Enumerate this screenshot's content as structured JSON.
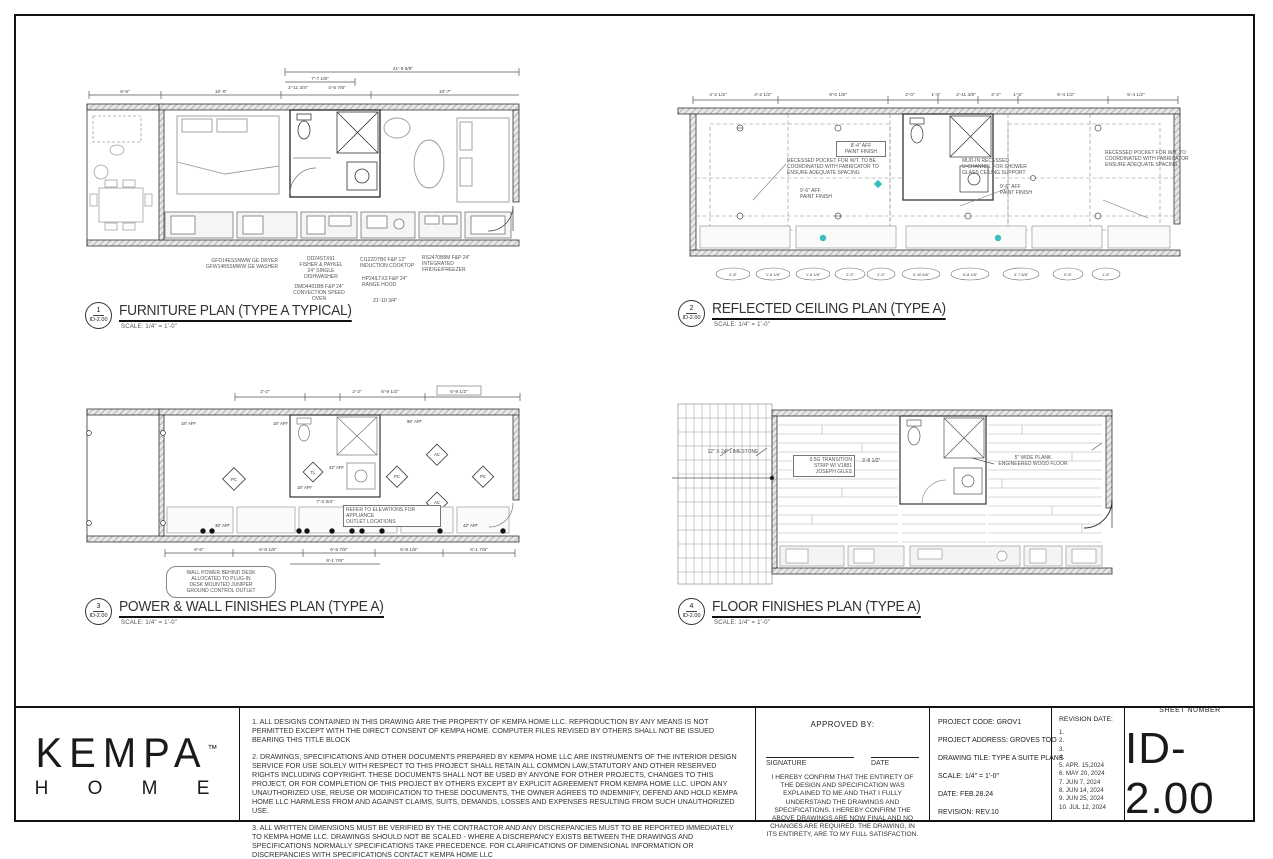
{
  "titles": {
    "furniture": {
      "num": "1",
      "ref": "ID-2.00",
      "title": "FURNITURE PLAN (TYPE A TYPICAL)",
      "scale": "SCALE: 1/4\" = 1'-0\""
    },
    "rcp": {
      "num": "2",
      "ref": "ID-2.00",
      "title": "REFLECTED CEILING PLAN (TYPE A)",
      "scale": "SCALE: 1/4\" = 1'-0\""
    },
    "power": {
      "num": "3",
      "ref": "ID-2.00",
      "title": "POWER & WALL FINISHES PLAN (TYPE A)",
      "scale": "SCALE: 1/4\" = 1'-0\""
    },
    "floor": {
      "num": "4",
      "ref": "ID-2.00",
      "title": "FLOOR FINISHES PLAN (TYPE A)",
      "scale": "SCALE: 1/4\" = 1'-0\""
    }
  },
  "furniture": {
    "dims_top": [
      "21'-9 5/8\"",
      "7'-7 1/8\"",
      "8'-6\"",
      "10'-0\"",
      "10'-7\"",
      "2'-11 3/4\"",
      "4'-5 7/8\""
    ],
    "dim_bottom": "21'-10 3/4\"",
    "notes": [
      "GFD14ESSNWW GE DRYER\nGFW148SSMWW GE WASHER",
      "DD24STX61\nFISHER & PAYKEL\n24\" SINGLE\nDISHWASHER",
      "DMD4401BB F&P 24\"\nCONVECTION SPEED\nOVEN",
      "CI122DTB6 F&P 12\"\nINDUCTION COOKTOP",
      "HP24ILTX2 F&P 24\"\nRANGE HOOD",
      "RS2470B8M F&P 24\"\nINTEGRATED\nFRIDGE/FREEZER"
    ]
  },
  "rcp": {
    "dims_top": [
      "4'-2 1/2\"",
      "4'-2 1/2\"",
      "9'-0 1/8\"",
      "2'-0\"",
      "1'-6\"",
      "2'-11 3/8\"",
      "2'-2\"",
      "1'-5\"",
      "5'-4 1/2\"",
      "5'-4 1/2\""
    ],
    "bubbles": [
      "2'-8\"",
      "1'-6 1/8\"",
      "1'-6 1/8\"",
      "2'-0\"",
      "1'-5\"",
      "5'-10 5/8\"",
      "5'-8 1/8\"",
      "3'-7 5/8\"",
      "5'-8\"",
      "1'-6\""
    ],
    "notes": [
      "RECESSED POCKET FOR W/T. TO BE\nCOORDINATED WITH FABRICATOR TO\nENSURE ADEQUATE SPACING",
      "8'-4\" AFF\nPAINT FINISH",
      "9'-6\" AFF\nPAINT FINISH",
      "MUD-IN RECESSED\nU-CHANNEL FOR SHOWER\nGLASS CEILING SUPPORT",
      "9'-6\" AFF\nPAINT FINISH",
      "RECESSED POCKET FOR W/T. TO\nCOORDINATED WITH FABRICATOR\nENSURE ADEQUATE SPACING"
    ]
  },
  "power": {
    "dims_top": [
      "2'-2\"",
      "2'-2\"",
      "6'-9 1/2\"",
      "6'-9 1/2\""
    ],
    "dims_bottom": [
      "6'-6\"",
      "6'-6 1/8\"",
      "6'-5 7/8\"",
      "5'-8 1/8\"",
      "6'-1 7/8\"",
      "9'-1 7/8\""
    ],
    "dim_mid": "7'-3 3/4\"",
    "aff": [
      "18\" AFF",
      "18\" AFF",
      "96\" AFF",
      "42\" AFF",
      "18\" AFF",
      "36\" AFF",
      "42\" AFF"
    ],
    "tags": [
      "PC",
      "TL",
      "PC",
      "AC",
      "PC",
      "AC"
    ],
    "notes": [
      "REFER TO ELEVATIONS FOR APPLIANCE\nOUTLET LOCATIONS",
      "WALL POWER BEHIND DESK\nALLOCATED TO PLUG-IN\nDESK MOUNTED JUNIPER\nGROUND CONTROL OUTLET"
    ]
  },
  "floor": {
    "notes": [
      "12\" X 24\" LIMESTONE",
      "0.5G TRANSITION\nSTRIP W/ V1881\nJOSEPH GILES",
      "5\" WIDE PLANK\nENGINEERED WOOD FLOOR"
    ],
    "dim": "3'-8 1/2\""
  },
  "title_block": {
    "logo": {
      "brand": "KEMPA",
      "tm": "™",
      "word": "H O M E"
    },
    "notes": [
      "1. ALL DESIGNS CONTAINED IN THIS DRAWING ARE THE PROPERTY OF KEMPA HOME LLC. REPRODUCTION BY ANY MEANS IS NOT PERMITTED EXCEPT WITH THE DIRECT CONSENT OF KEMPA HOME. COMPUTER FILES REVISED BY OTHERS SHALL NOT BE ISSUED BEARING THIS TITLE BLOCK",
      "2. DRAWINGS, SPECIFICATIONS AND OTHER DOCUMENTS PREPARED BY KEMPA HOME LLC ARE INSTRUMENTS OF THE INTERIOR DESIGN SERVICE FOR USE SOLELY WITH RESPECT TO THIS PROJECT SHALL RETAIN ALL COMMON LAW,STATUTORY AND OTHER RESERVED RIGHTS INCLUDING COPYRIGHT. THESE DOCUMENTS SHALL NOT BE USED BY ANYONE FOR OTHER PROJECTS, CHANGES TO THIS PROJECT, OR FOR COMPLETION OF THIS PROJECT BY OTHERS EXCEPT BY EXPLICIT AGREEMENT FROM KEMPA HOME LLC. UPON ANY UNAUTHORIZED USE, REUSE OR MODIFICATION TO THESE DOCUMENTS, THE OWNER AGREES TO INDEMNIFY, DEFEND AND HOLD KEMPA HOME LLC HARMLESS FROM AND AGAINST CLAIMS, SUITS, DEMANDS, LOSSES AND EXPENSES RESULTING FROM SUCH UNAUTHORIZED USE.",
      "3. ALL WRITTEN DIMENSIONS MUST BE VERIFIED BY THE CONTRACTOR AND ANY DISCREPANCIES MUST TO BE REPORTED IMMEDIATELY TO KEMPA HOME LLC. DRAWINGS SHOULD NOT BE SCALED - WHERE A DISCREPANCY EXISTS BETWEEN THE DRAWINGS AND SPECIFICATIONS NORMALLY SPECIFICATIONS TAKE PRECEDENCE. FOR CLARIFICATIONS OF DIMENSIONAL INFORMATION OR DISCREPANCIES WITH SPECIFICATIONS CONTACT KEMPA HOME LLC"
    ],
    "approval": {
      "heading": "APPROVED BY:",
      "signature_label": "SIGNATURE",
      "date_label": "DATE",
      "statement": "I HEREBY CONFIRM THAT THE ENTIRETY OF THE DESIGN AND SPECIFICATION WAS EXPLAINED TO ME AND THAT I FULLY UNDERSTAND THE DRAWINGS AND SPECIFICATIONS. I HEREBY CONFIRM THE ABOVE DRAWINGS ARE NOW FINAL AND NO CHANGES ARE REQUIRED. THE DRAWING, IN ITS ENTIRETY, ARE TO MY FULL SATISFACTION."
    },
    "project": {
      "code": "PROJECT CODE: GROV1",
      "address": "PROJECT ADDRESS: GROVES TOO",
      "drawing": "DRAWING TILE: TYPE A SUITE PLANS",
      "scale": "SCALE: 1/4\" = 1'-0\"",
      "date": "DATE: FEB.28.24",
      "revision": "REVISION: REV.10"
    },
    "revisions": {
      "heading": "REVISION DATE:",
      "items": [
        "1.",
        "2.",
        "3.",
        "4.",
        "5. APR. 15,2024",
        "6. MAY 20, 2024",
        "7. JUN 7, 2024",
        "8. JUN 14, 2024",
        "9. JUN 25, 2024",
        "10. JUL 12, 2024"
      ]
    },
    "sheet": {
      "label": "SHEET NUMBER",
      "number": "ID-2.00"
    }
  }
}
